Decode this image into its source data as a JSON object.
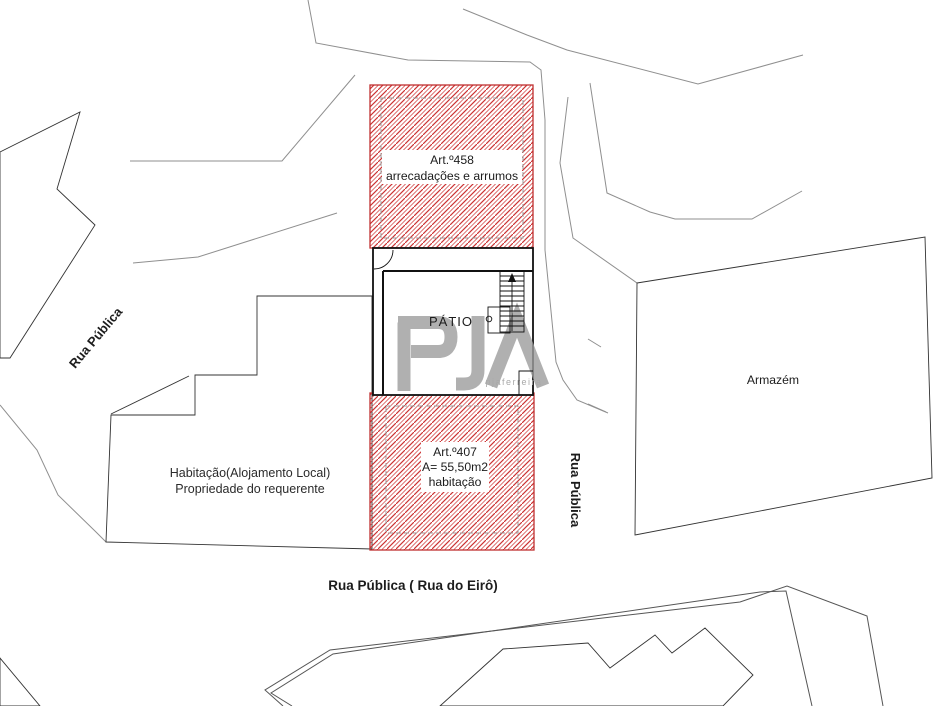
{
  "labels": {
    "art458": {
      "line1": "Art.º458",
      "line2": "arrecadações e arrumos"
    },
    "art407": {
      "line1": "Art.º407",
      "line2": "A= 55,50m2",
      "line3": "habitação"
    },
    "patio": "PÁTIO",
    "armazem": "Armazém",
    "habitacao": {
      "line1": "Habitação(Alojamento Local)",
      "line2": "Propriedade do requerente"
    },
    "rua_publica_left": "Rua Pública",
    "rua_publica_right": "Rua Pública",
    "rua_eiro": "Rua Pública ( Rua do Eirô)",
    "watermark": {
      "logo": "PJA",
      "subtext": "pjaferreira"
    }
  },
  "colors": {
    "red_hatch": "#cc3333",
    "red_border": "#c03030",
    "gray_line": "#8f8f8f",
    "dashed_gray": "#9a9a9a",
    "watermark_gray": "#9c9c9c"
  }
}
